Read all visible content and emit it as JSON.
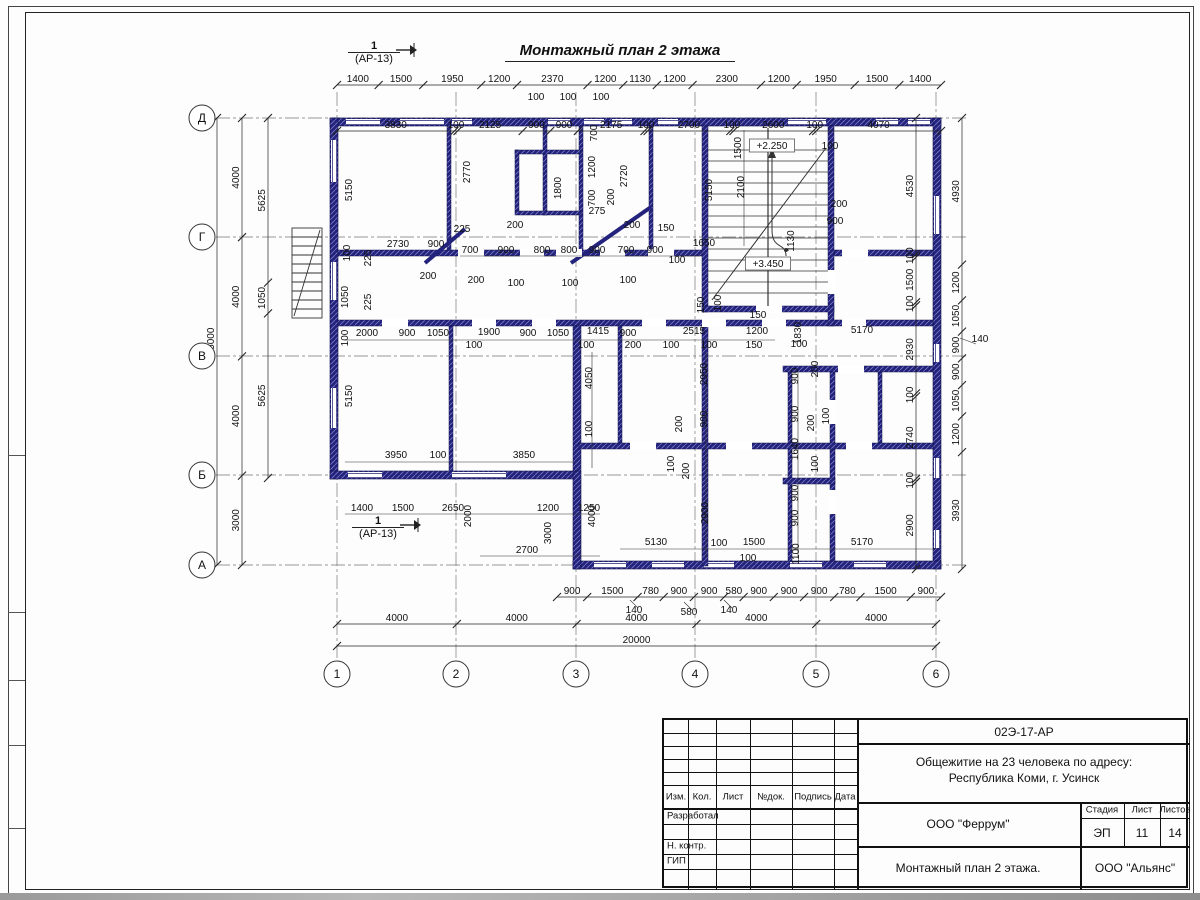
{
  "title": "Монтажный план 2 этажа",
  "section_marker": {
    "num": "1",
    "ref": "(АР-13)"
  },
  "axes": {
    "rows": [
      "Д",
      "Г",
      "В",
      "Б",
      "А"
    ],
    "cols": [
      "1",
      "2",
      "3",
      "4",
      "5",
      "6"
    ]
  },
  "chains": {
    "top_outer": [
      "1400",
      "1500",
      "1950",
      "1200",
      "2370",
      "1200",
      "1130",
      "1200",
      "2300",
      "1200",
      "1950",
      "1500",
      "1400"
    ],
    "top_inner": [
      "3830",
      "100",
      "2125",
      "900",
      "900",
      "2175",
      "100",
      "2700",
      "100",
      "2600",
      "100",
      "4070"
    ],
    "left_outer": [
      "4000",
      "4000",
      "4000",
      "3000"
    ],
    "left_mid": [
      "5625",
      "1050",
      "5625"
    ],
    "left_total": [
      "15000"
    ],
    "right_inner": [
      "4530",
      "100",
      "1500",
      "100",
      "2930",
      "100",
      "2740",
      "100",
      "2900"
    ],
    "right_outer": [
      "4930",
      "1200",
      "1050",
      "900",
      "900",
      "1050",
      "1200",
      "3930"
    ],
    "bottom_inner": [
      "900",
      "1500",
      "780",
      "900",
      "900",
      "580",
      "900",
      "900",
      "900",
      "780",
      "1500",
      "900"
    ],
    "bottom_axes": [
      "4000",
      "4000",
      "4000",
      "4000",
      "4000"
    ],
    "bottom_total": [
      "20000"
    ]
  },
  "labels": [
    [
      536,
      100,
      "100",
      0
    ],
    [
      568,
      100,
      "100",
      0
    ],
    [
      601,
      100,
      "100",
      0
    ],
    [
      352,
      190,
      "5150",
      1
    ],
    [
      470,
      172,
      "2770",
      1
    ],
    [
      561,
      188,
      "1800",
      1
    ],
    [
      597,
      133,
      "700",
      1
    ],
    [
      595,
      167,
      "1200",
      1
    ],
    [
      595,
      198,
      "700",
      1
    ],
    [
      614,
      197,
      "200",
      1
    ],
    [
      597,
      214,
      "275",
      0
    ],
    [
      627,
      176,
      "2720",
      1
    ],
    [
      712,
      190,
      "5150",
      1
    ],
    [
      741,
      148,
      "1500",
      1
    ],
    [
      744,
      187,
      "2100",
      1
    ],
    [
      772,
      146,
      "+2.250",
      2
    ],
    [
      768,
      264,
      "+3.450",
      2
    ],
    [
      830,
      149,
      "100",
      0
    ],
    [
      839,
      207,
      "200",
      0
    ],
    [
      835,
      224,
      "900",
      0
    ],
    [
      794,
      241,
      "1130",
      1
    ],
    [
      398,
      247,
      "2730",
      0
    ],
    [
      436,
      247,
      "900",
      0
    ],
    [
      462,
      232,
      "225",
      0
    ],
    [
      515,
      228,
      "200",
      0
    ],
    [
      632,
      228,
      "200",
      0
    ],
    [
      666,
      231,
      "150",
      0
    ],
    [
      704,
      246,
      "1650",
      0
    ],
    [
      470,
      253,
      "700",
      0
    ],
    [
      506,
      253,
      "900",
      0
    ],
    [
      542,
      253,
      "800",
      0
    ],
    [
      569,
      253,
      "800",
      0
    ],
    [
      597,
      253,
      "900",
      0
    ],
    [
      626,
      253,
      "700",
      0
    ],
    [
      655,
      253,
      "900",
      0
    ],
    [
      677,
      263,
      "100",
      0
    ],
    [
      428,
      279,
      "200",
      0
    ],
    [
      476,
      283,
      "200",
      0
    ],
    [
      516,
      286,
      "100",
      0
    ],
    [
      570,
      286,
      "100",
      0
    ],
    [
      628,
      283,
      "100",
      0
    ],
    [
      350,
      253,
      "100",
      1
    ],
    [
      371,
      258,
      "225",
      1
    ],
    [
      348,
      297,
      "1050",
      1
    ],
    [
      371,
      302,
      "225",
      1
    ],
    [
      348,
      338,
      "100",
      1
    ],
    [
      367,
      336,
      "2000",
      0
    ],
    [
      407,
      336,
      "900",
      0
    ],
    [
      438,
      336,
      "1050",
      0
    ],
    [
      489,
      335,
      "1900",
      0
    ],
    [
      528,
      336,
      "900",
      0
    ],
    [
      558,
      336,
      "1050",
      0
    ],
    [
      598,
      334,
      "1415",
      0
    ],
    [
      628,
      336,
      "900",
      0
    ],
    [
      694,
      334,
      "2515",
      0
    ],
    [
      757,
      334,
      "1200",
      0
    ],
    [
      704,
      305,
      "150",
      1
    ],
    [
      721,
      303,
      "100",
      1
    ],
    [
      758,
      318,
      "150",
      0
    ],
    [
      801,
      333,
      "1830",
      1
    ],
    [
      862,
      333,
      "5170",
      0
    ],
    [
      474,
      348,
      "100",
      0
    ],
    [
      586,
      348,
      "100",
      0
    ],
    [
      633,
      348,
      "200",
      0
    ],
    [
      671,
      348,
      "100",
      0
    ],
    [
      709,
      348,
      "100",
      0
    ],
    [
      754,
      348,
      "150",
      0
    ],
    [
      799,
      347,
      "100",
      0
    ],
    [
      592,
      378,
      "4050",
      1
    ],
    [
      592,
      429,
      "100",
      1
    ],
    [
      707,
      374,
      "2950",
      1
    ],
    [
      798,
      376,
      "900",
      1
    ],
    [
      818,
      369,
      "200",
      1
    ],
    [
      707,
      419,
      "900",
      1
    ],
    [
      682,
      424,
      "200",
      1
    ],
    [
      798,
      414,
      "900",
      1
    ],
    [
      814,
      423,
      "200",
      1
    ],
    [
      829,
      416,
      "100",
      1
    ],
    [
      798,
      449,
      "1640",
      1
    ],
    [
      818,
      464,
      "100",
      1
    ],
    [
      674,
      464,
      "100",
      1
    ],
    [
      689,
      471,
      "200",
      1
    ],
    [
      352,
      396,
      "5150",
      1
    ],
    [
      396,
      458,
      "3950",
      0
    ],
    [
      438,
      458,
      "100",
      0
    ],
    [
      524,
      458,
      "3850",
      0
    ],
    [
      708,
      513,
      "2900",
      1
    ],
    [
      798,
      493,
      "900",
      1
    ],
    [
      798,
      518,
      "900",
      1
    ],
    [
      799,
      554,
      "1100",
      1
    ],
    [
      656,
      545,
      "5130",
      0
    ],
    [
      719,
      546,
      "100",
      0
    ],
    [
      754,
      545,
      "1500",
      0
    ],
    [
      748,
      561,
      "100",
      0
    ],
    [
      862,
      545,
      "5170",
      0
    ],
    [
      362,
      511,
      "1400",
      0
    ],
    [
      403,
      511,
      "1500",
      0
    ],
    [
      453,
      511,
      "2650",
      0
    ],
    [
      548,
      511,
      "1200",
      0
    ],
    [
      589,
      511,
      "1250",
      0
    ],
    [
      471,
      516,
      "2000",
      1
    ],
    [
      551,
      533,
      "3000",
      1
    ],
    [
      527,
      553,
      "2700",
      0
    ],
    [
      595,
      516,
      "4000",
      1
    ],
    [
      634,
      613,
      "140",
      0
    ],
    [
      689,
      615,
      "580",
      0
    ],
    [
      729,
      613,
      "140",
      0
    ],
    [
      980,
      342,
      "140",
      0
    ]
  ],
  "titleblock": {
    "doc_number": "02Э-17-АР",
    "project_line1": "Общежитие на 23 человека по адресу:",
    "project_line2": "Республика Коми, г. Усинск",
    "designer_org": "ООО \"Феррум\"",
    "sheet_title": "Монтажный план 2 этажа.",
    "contractor_org": "ООО \"Альянс\"",
    "stage_label": "Стадия",
    "stage_value": "ЭП",
    "sheet_label": "Лист",
    "sheet_value": "11",
    "sheets_label": "Листов",
    "sheets_value": "14",
    "hdr_izm": "Изм.",
    "hdr_kol": "Кол.",
    "hdr_list": "Лист",
    "hdr_doc": "№док.",
    "hdr_sign": "Подпись",
    "hdr_date": "Дата",
    "role_1": "Разработал",
    "role_2": "Н. контр.",
    "role_3": "ГИП"
  }
}
